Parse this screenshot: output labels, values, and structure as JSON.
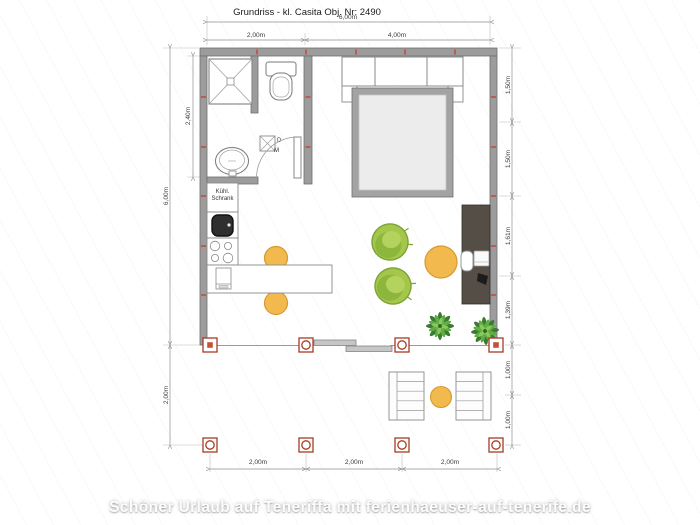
{
  "title": "Grundriss - kl. Casita Obj. Nr: 2490",
  "watermark": "Schöner Urlaub auf Teneriffa mit ferienhaeuser-auf-tenerife.de",
  "room_labels": {
    "fridge_line1": "Kühl.",
    "fridge_line2": "Schrank",
    "washer_top": "D",
    "washer_bottom": "M"
  },
  "dimensions": {
    "top_total": "6,00m",
    "top_left": "2,00m",
    "top_right": "4,00m",
    "left_bath": "2,40m",
    "left_main": "6,00m",
    "left_terrace": "2,00m",
    "right": [
      "1,50m",
      "1,50m",
      "1,61m",
      "1,39m",
      "1,00m",
      "1,00m"
    ],
    "bottom": [
      "2,00m",
      "2,00m",
      "2,00m"
    ]
  },
  "colors": {
    "wall_gray": "#9c9c9c",
    "post_red": "#a63b24",
    "tick_red": "#cf3a2d",
    "chair_green": "#a4c64a",
    "table_orange": "#f2b94e",
    "desk_brown": "#544e46"
  }
}
